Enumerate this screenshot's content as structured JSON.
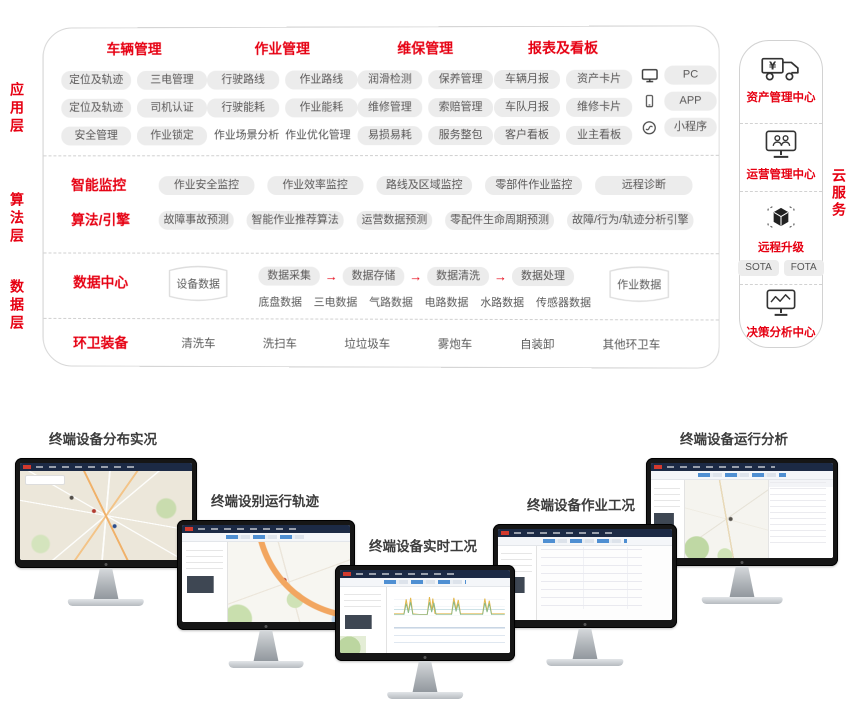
{
  "colors": {
    "accent": "#e60012",
    "pill_bg": "#ececec",
    "pill_text": "#595757",
    "panel_border": "#d6d6d6",
    "monitor_header": "#1c2a45"
  },
  "layer_labels": {
    "app": "应用层",
    "algo": "算法层",
    "data": "数据层"
  },
  "app_layer": {
    "groups": [
      {
        "title": "车辆管理",
        "rows": [
          [
            {
              "t": "定位及轨迹"
            },
            {
              "t": "三电管理"
            }
          ],
          [
            {
              "t": "定位及轨迹"
            },
            {
              "t": "司机认证"
            }
          ],
          [
            {
              "t": "安全管理"
            },
            {
              "t": "作业锁定"
            }
          ]
        ]
      },
      {
        "title": "作业管理",
        "rows": [
          [
            {
              "t": "行驶路线"
            },
            {
              "t": "作业路线"
            }
          ],
          [
            {
              "t": "行驶能耗"
            },
            {
              "t": "作业能耗"
            }
          ],
          [
            {
              "t": "作业场景分析",
              "plain": "1"
            },
            {
              "t": "作业优化管理",
              "plain": "1"
            }
          ]
        ]
      },
      {
        "title": "维保管理",
        "rows": [
          [
            {
              "t": "润滑检测"
            },
            {
              "t": "保养管理"
            }
          ],
          [
            {
              "t": "维修管理"
            },
            {
              "t": "索赔管理"
            }
          ],
          [
            {
              "t": "易损易耗"
            },
            {
              "t": "服务整包"
            }
          ]
        ]
      },
      {
        "title": "报表及看板",
        "rows": [
          [
            {
              "t": "车辆月报"
            },
            {
              "t": "资产卡片"
            }
          ],
          [
            {
              "t": "车队月报"
            },
            {
              "t": "维修卡片"
            }
          ],
          [
            {
              "t": "客户看板"
            },
            {
              "t": "业主看板"
            }
          ]
        ]
      }
    ],
    "terminals": [
      {
        "icon": "pc-icon",
        "label": "PC"
      },
      {
        "icon": "phone-icon",
        "label": "APP"
      },
      {
        "icon": "mini-icon",
        "label": "小程序"
      }
    ]
  },
  "algo_layer": {
    "rows": [
      {
        "title": "智能监控",
        "pills": [
          "作业安全监控",
          "作业效率监控",
          "路线及区域监控",
          "零部件作业监控",
          "远程诊断"
        ]
      },
      {
        "title": "算法/引擎",
        "pills": [
          "故障事故预测",
          "智能作业推荐算法",
          "运营数据预测",
          "零配件生命周期预测",
          "故障/行为/轨迹分析引擎"
        ]
      }
    ]
  },
  "data_layer": {
    "title": "数据中心",
    "device_db": "设备数据",
    "job_db": "作业数据",
    "pipeline": [
      "数据采集",
      "数据存储",
      "数据清洗",
      "数据处理"
    ],
    "data_types": [
      "底盘数据",
      "三电数据",
      "气路数据",
      "电路数据",
      "水路数据",
      "传感器数据"
    ],
    "equipment_title": "环卫装备",
    "equipment": [
      "清洗车",
      "洗扫车",
      "垃垃圾车",
      "雾炮车",
      "自装卸",
      "其他环卫车"
    ]
  },
  "cloud_rail": {
    "label": "云服务",
    "items": [
      {
        "icon": "truck-yen-icon",
        "title": "资产管理中心"
      },
      {
        "icon": "monitor-users-icon",
        "title": "运营管理中心"
      },
      {
        "icon": "cube-icon",
        "title": "远程升级",
        "tags": [
          "SOTA",
          "FOTA"
        ]
      },
      {
        "icon": "monitor-chart-icon",
        "title": "决策分析中心"
      }
    ]
  },
  "monitors": [
    {
      "label": "终端设备分布实况",
      "screen": "map-full"
    },
    {
      "label": "终端设别运行轨迹",
      "screen": "map-sidebar"
    },
    {
      "label": "终端设备实时工况",
      "screen": "charts"
    },
    {
      "label": "终端设备作业工况",
      "screen": "tables"
    },
    {
      "label": "终端设备运行分析",
      "screen": "map-panel"
    }
  ]
}
